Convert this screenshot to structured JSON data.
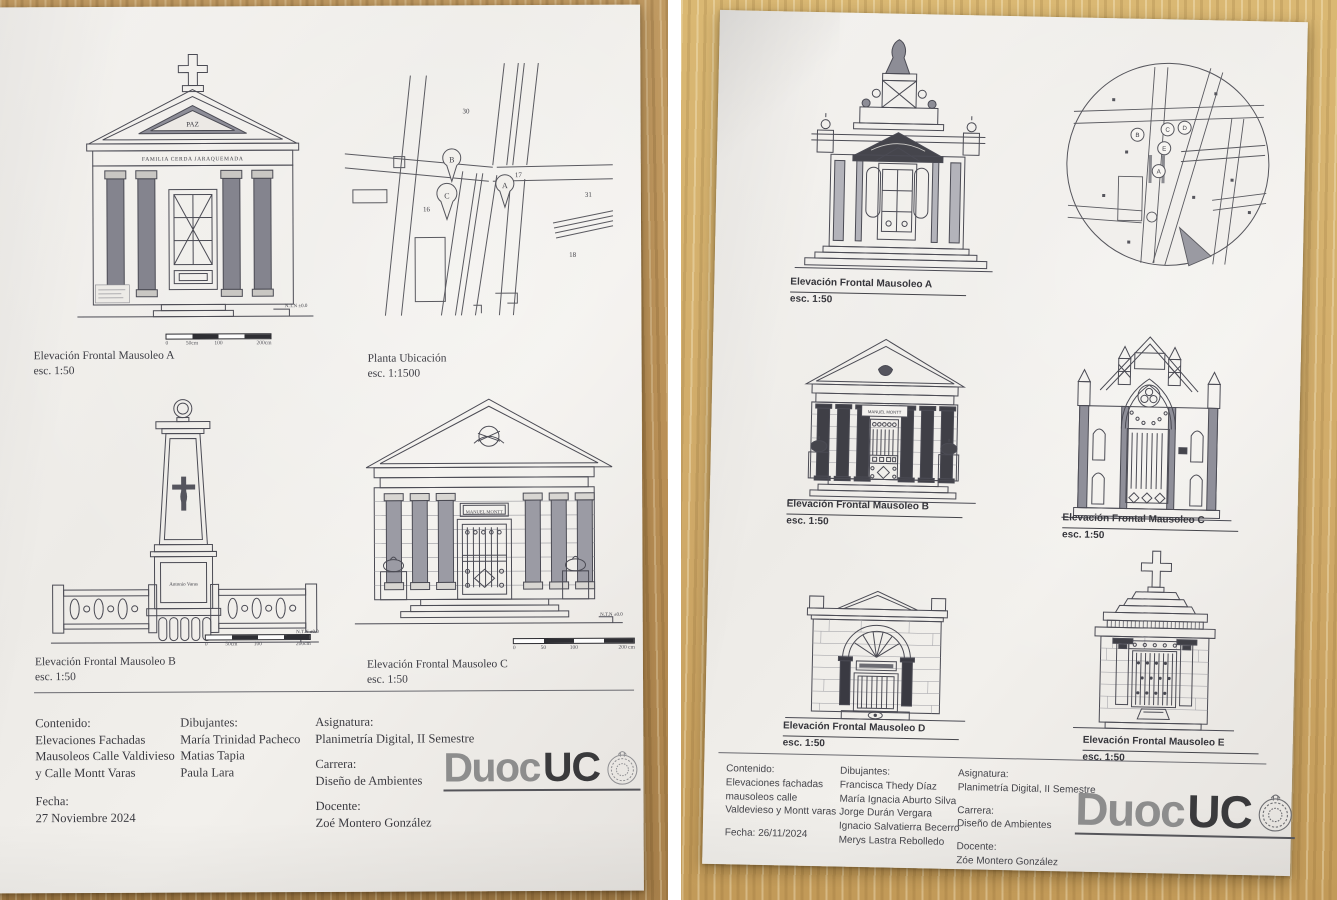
{
  "left_sheet": {
    "drawing_a": {
      "title": "Elevación Frontal Mausoleo A",
      "scale": "esc. 1:50",
      "pediment_inscription": "PAZ",
      "frieze_inscription": "FAMILIA CERDA JARAQUEMADA",
      "level_note": "N.T.N ±0.0",
      "scalebar_ticks": [
        "0",
        "50cm",
        "100",
        "200cm"
      ]
    },
    "site_plan": {
      "title": "Planta Ubicación",
      "scale": "esc. 1:1500",
      "pins": [
        "B",
        "C",
        "A"
      ],
      "block_numbers": [
        "30",
        "17",
        "31",
        "16",
        "18"
      ]
    },
    "drawing_b": {
      "title": "Elevación Frontal Mausoleo B",
      "scale": "esc. 1:50",
      "inscription": "Antonio Varas",
      "level_note": "N.T.N ±0.0",
      "scalebar_ticks": [
        "0",
        "50cm",
        "100",
        "200cm"
      ]
    },
    "drawing_c": {
      "title": "Elevación Frontal Mausoleo C",
      "scale": "esc. 1:50",
      "plaque_inscription": "MANUEL MONTT",
      "level_note": "N.T.N ±0.0",
      "scalebar_ticks": [
        "0",
        "50",
        "100",
        "200 cm"
      ]
    },
    "title_block": {
      "contenido_label": "Contenido:",
      "contenido_lines": [
        "Elevaciones Fachadas",
        "Mausoleos Calle Valdivieso",
        "y Calle Montt Varas"
      ],
      "fecha_label": "Fecha:",
      "fecha": "27 Noviembre 2024",
      "dibujantes_label": "Dibujantes:",
      "dibujantes": [
        "María Trinidad Pacheco",
        "Matias Tapia",
        "Paula Lara"
      ],
      "asignatura_label": "Asignatura:",
      "asignatura": "Planimetría Digital, II Semestre",
      "carrera_label": "Carrera:",
      "carrera": "Diseño de Ambientes",
      "docente_label": "Docente:",
      "docente": "Zoé Montero González"
    },
    "logo": {
      "part1": "Duoc",
      "part2": "UC"
    }
  },
  "right_sheet": {
    "drawing_a": {
      "title": "Elevación Frontal Mausoleo A",
      "scale": "esc. 1:50"
    },
    "site_plan": {
      "pins": [
        "B",
        "C",
        "D",
        "E",
        "A"
      ]
    },
    "drawing_b": {
      "title": "Elevación Frontal Mausoleo B",
      "scale": "esc. 1:50",
      "plaque_inscription": "MANUEL MONTT"
    },
    "drawing_c": {
      "title": "Elevación Frontal Mausoleo C",
      "scale": "esc. 1:50"
    },
    "drawing_d": {
      "title": "Elevación Frontal Mausoleo D",
      "scale": "esc. 1:50"
    },
    "drawing_e": {
      "title": "Elevación Frontal Mausoleo E",
      "scale": "esc. 1:50"
    },
    "title_block": {
      "contenido_label": "Contenido:",
      "contenido_lines": [
        "Elevaciones fachadas",
        "mausoleos calle",
        "Valdevieso y Montt varas"
      ],
      "fecha": "Fecha: 26/11/2024",
      "dibujantes_label": "Dibujantes:",
      "dibujantes": [
        "Francisca Thedy Díaz",
        "María Ignacia Aburto Silva",
        "Jorge Durán Vergara",
        "Ignacio Salvatierra Becerro",
        "Merys Lastra Rebolledo"
      ],
      "asignatura_label": "Asignatura:",
      "asignatura": "Planimetría Digital, II Semestre",
      "carrera_label": "Carrera:",
      "carrera": "Diseño de Ambientes",
      "docente_label": "Docente:",
      "docente": "Zóe Montero González"
    },
    "logo": {
      "part1": "Duoc",
      "part2": "UC"
    }
  }
}
